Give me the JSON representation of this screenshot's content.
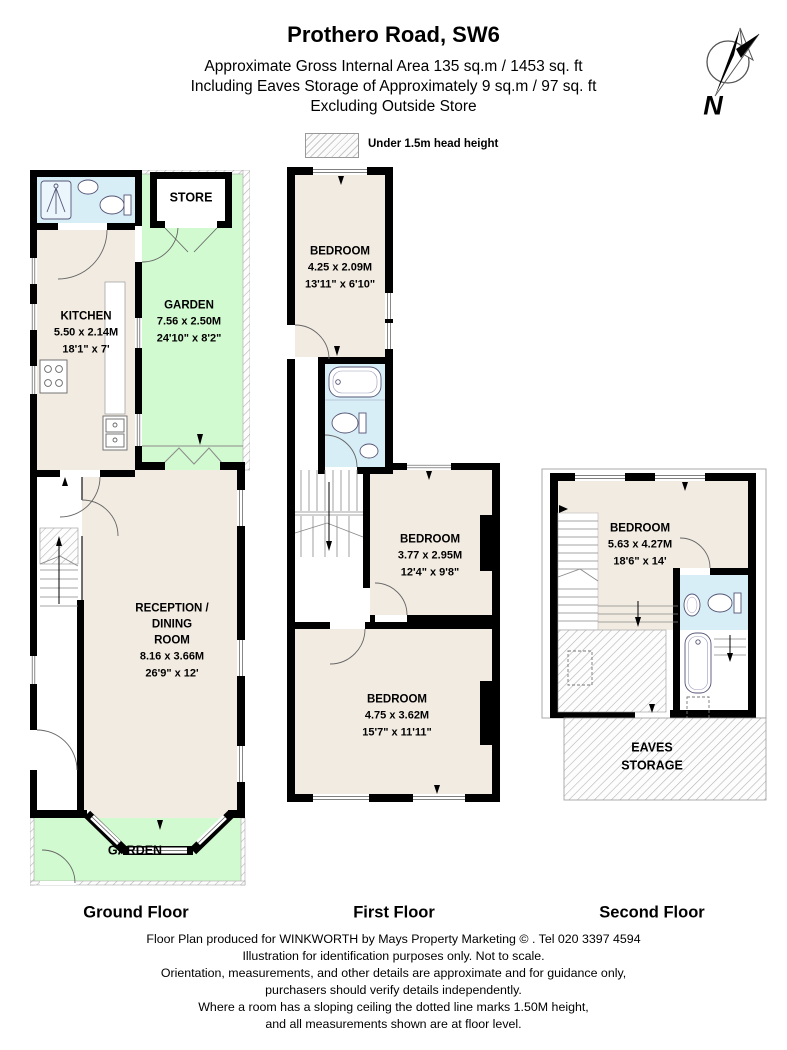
{
  "header": {
    "title": "Prothero Road, SW6",
    "line1": "Approximate Gross Internal Area 135 sq.m  /  1453 sq. ft",
    "line2": "Including Eaves Storage of Approximately 9 sq.m  /  97 sq. ft",
    "line3": "Excluding Outside Store"
  },
  "legend": {
    "label": "Under 1.5m head height"
  },
  "north": {
    "label": "N"
  },
  "colors": {
    "room": "#f2ebe2",
    "bathroom": "#d8eef6",
    "garden": "#d2fad0",
    "wall": "#000000"
  },
  "floors": [
    {
      "label": "Ground Floor",
      "rooms": [
        {
          "name": "STORE"
        },
        {
          "name": "KITCHEN",
          "metric": "5.50 x 2.14M",
          "imperial": "18'1\" x 7'"
        },
        {
          "name": "GARDEN",
          "metric": "7.56 x 2.50M",
          "imperial": "24'10\" x 8'2\""
        },
        {
          "name": "RECEPTION /\nDINING\nROOM",
          "metric": "8.16 x 3.66M",
          "imperial": "26'9\" x 12'"
        },
        {
          "name": "GARDEN"
        }
      ]
    },
    {
      "label": "First Floor",
      "rooms": [
        {
          "name": "BEDROOM",
          "metric": "4.25 x 2.09M",
          "imperial": "13'11\" x 6'10\""
        },
        {
          "name": "BEDROOM",
          "metric": "3.77 x 2.95M",
          "imperial": "12'4\" x 9'8\""
        },
        {
          "name": "BEDROOM",
          "metric": "4.75 x 3.62M",
          "imperial": "15'7\" x 11'11\""
        }
      ]
    },
    {
      "label": "Second Floor",
      "rooms": [
        {
          "name": "BEDROOM",
          "metric": "5.63 x 4.27M",
          "imperial": "18'6\" x 14'"
        },
        {
          "name": "EAVES\nSTORAGE"
        }
      ]
    }
  ],
  "footer": {
    "lines": [
      "Floor Plan produced for WINKWORTH by Mays Property Marketing  © . Tel 020 3397 4594",
      "Illustration for identification purposes only. Not to scale.",
      "Orientation, measurements, and other details are approximate and for guidance only,",
      "purchasers should verify details independently.",
      "Where a room has a sloping ceiling the dotted line marks 1.50M height,",
      "and all measurements shown are at floor level."
    ]
  }
}
